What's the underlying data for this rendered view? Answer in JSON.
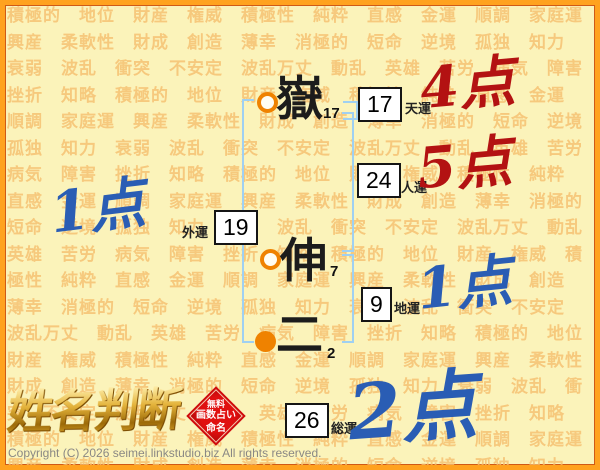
{
  "background": {
    "repeat": 6,
    "words": [
      "積極的",
      "地位",
      "財産",
      "権威",
      "積極性",
      "純粋",
      "直感",
      "金運",
      "順調",
      "家庭運",
      "興産",
      "柔軟性",
      "財成",
      "創造",
      "薄幸",
      "消極的",
      "短命",
      "逆境",
      "孤独",
      "知力",
      "衰弱",
      "波乱",
      "衝突",
      "不安定",
      "波乱万丈",
      "動乱",
      "英雄",
      "苦労",
      "病気",
      "障害",
      "挫折",
      "知略"
    ]
  },
  "name_column": {
    "characters": [
      {
        "char": "嶽",
        "strokes": "17",
        "marker": "hollow-circle"
      },
      {
        "char": "伸",
        "strokes": "7",
        "marker": "hollow-circle"
      },
      {
        "char": "二",
        "strokes": "2",
        "marker": "filled-circle"
      }
    ]
  },
  "fortunes": {
    "tenun": {
      "label": "天運",
      "value": "17",
      "score": "4点",
      "score_color": "#b31212"
    },
    "jinun": {
      "label": "人運",
      "value": "24",
      "score": "5点",
      "score_color": "#b31212"
    },
    "gaiun": {
      "label": "外運",
      "value": "19",
      "score": "1点",
      "score_color": "#2a5db4"
    },
    "chiun": {
      "label": "地運",
      "value": "9",
      "score": "1点",
      "score_color": "#2a5db4"
    },
    "souun": {
      "label": "総運",
      "value": "26",
      "score": "2点",
      "score_color": "#2a5db4"
    }
  },
  "branding": {
    "logo": "姓名判断",
    "stamp_lines": [
      "無料",
      "画数占い",
      "命名"
    ]
  },
  "footer": {
    "copyright": "Copyright (C) 2026 seimei.linkstudio.biz All rights reserved."
  },
  "colors": {
    "frame": "#ffa21f",
    "background": "#fbf3ba",
    "background_words": "#f6bf6f",
    "bracket": "#9fd0f2",
    "marker_orange": "#ef8200",
    "score_red": "#b31212",
    "score_blue": "#2a5db4",
    "stamp_red": "#d40d0d",
    "copyright_gray": "#8a8884"
  }
}
